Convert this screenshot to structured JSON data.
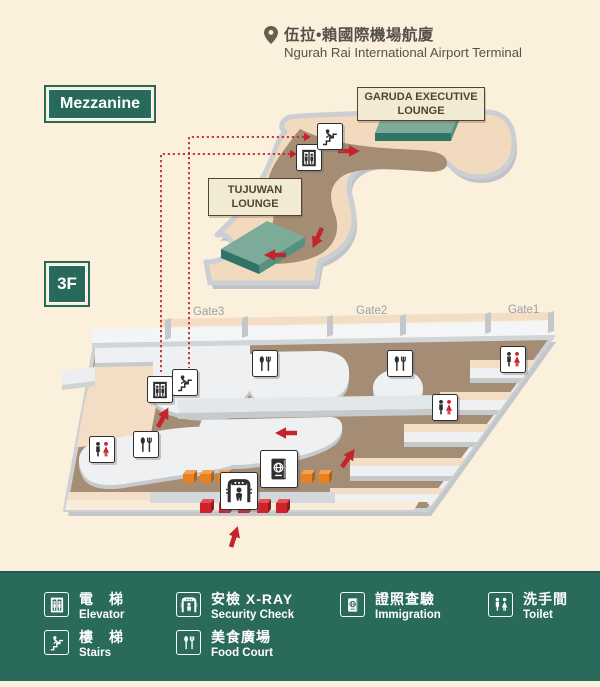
{
  "header": {
    "title_zh": "伍拉•賴國際機場航廈",
    "title_en": "Ngurah Rai International Airport Terminal"
  },
  "level_labels": {
    "mezzanine": "Mezzanine",
    "third_floor": "3F"
  },
  "lounge_labels": {
    "garuda_line1": "GARUDA EXECUTIVE",
    "garuda_line2": "LOUNGE",
    "tujuwan_line1": "TUJUWAN",
    "tujuwan_line2": "LOUNGE"
  },
  "gates": {
    "gate3": "Gate3",
    "gate2": "Gate2",
    "gate1": "Gate1"
  },
  "legend": {
    "elevator": {
      "icon": "elevator-icon",
      "zh": "電　梯",
      "en": "Elevator"
    },
    "security": {
      "icon": "security-check-icon",
      "zh": "安檢 X-RAY",
      "en": "Security Check"
    },
    "immigration": {
      "icon": "immigration-icon",
      "zh": "證照查驗",
      "en": "Immigration"
    },
    "toilet": {
      "icon": "toilet-icon",
      "zh": "洗手間",
      "en": "Toilet"
    },
    "stairs": {
      "icon": "stairs-icon",
      "zh": "樓　梯",
      "en": "Stairs"
    },
    "food_court": {
      "icon": "food-court-icon",
      "zh": "美食廣場",
      "en": "Food Court"
    }
  },
  "colors": {
    "background": "#faf0dc",
    "legend_green": "#2a6a5b",
    "badge_green": "#276a5b",
    "lounge_block_green_top": "#7dab99",
    "lounge_block_green_side": "#2f7466",
    "floor_peach": "#f2dabf",
    "walkway_brown": "#a58c75",
    "edge_gray": "#cbcfd3",
    "island_white": "#eef0f1",
    "flow_arrow_red": "#c4242b",
    "belt_orange": "#e8821e",
    "label_box_bg": "#f2ebd4",
    "label_box_border": "#54432f",
    "gate_text_gray": "#9aa0a6"
  }
}
